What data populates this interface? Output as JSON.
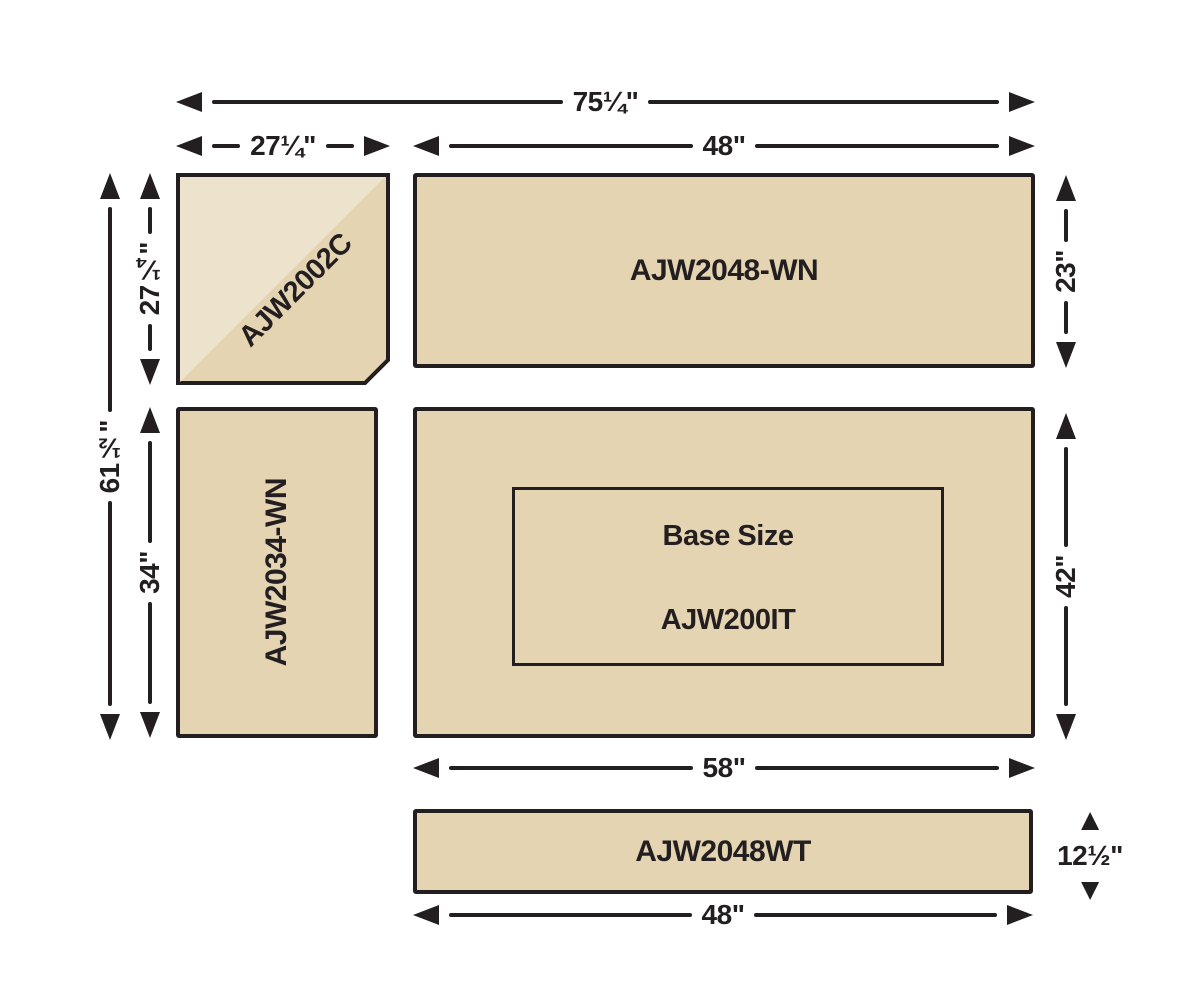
{
  "diagram": {
    "pieces": {
      "corner": {
        "label": "AJW2002C"
      },
      "top": {
        "label": "AJW2048-WN"
      },
      "left": {
        "label": "AJW2034-WN"
      },
      "base": {
        "title": "Base Size",
        "model": "AJW200IT"
      },
      "bottom": {
        "label": "AJW2048WT"
      }
    },
    "dimensions": {
      "overall_width": "75¼\"",
      "corner_width": "27¼\"",
      "top_width": "48\"",
      "overall_height": "61½\"",
      "corner_height": "27¼\"",
      "left_height": "34\"",
      "top_height": "23\"",
      "base_height": "42\"",
      "base_width": "58\"",
      "bottom_height": "12½\"",
      "bottom_width": "48\""
    },
    "colors": {
      "fill": "#e4d4b2",
      "fill_light": "#ede3cc",
      "line": "#231f20",
      "background": "#ffffff"
    }
  }
}
